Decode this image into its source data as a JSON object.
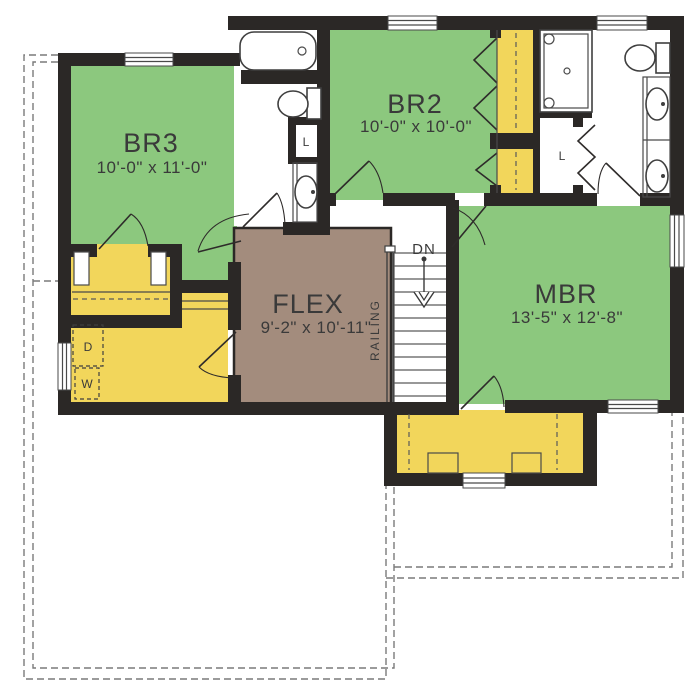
{
  "rooms": [
    {
      "name": "BR3",
      "dims": "10'-0\" x 11'-0\""
    },
    {
      "name": "BR2",
      "dims": "10'-0\" x 10'-0\""
    },
    {
      "name": "FLEX",
      "dims": "9'-2\" x 10'-11\""
    },
    {
      "name": "MBR",
      "dims": "13'-5\" x 12'-8\""
    }
  ],
  "stairs": {
    "down_label": "DN",
    "railing_label": "RAILING"
  },
  "closets": {
    "linen_label": "L"
  },
  "laundry": {
    "dryer_label": "D",
    "washer_label": "W"
  },
  "colors": {
    "bedroom_green": "#8cc87e",
    "closet_yellow": "#f2d65b",
    "flex_brown": "#a38c7d",
    "wall_black": "#2b2826",
    "fixture_line": "#3f3f3f",
    "dashed_outline": "#7a7a7a",
    "label_text": "#3a3a3a"
  }
}
